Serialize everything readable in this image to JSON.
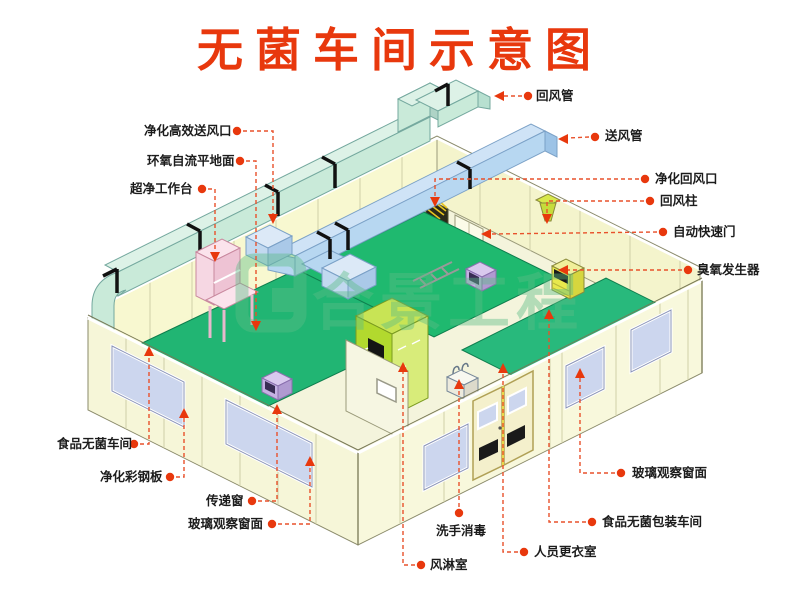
{
  "title": "无菌车间示意图",
  "watermark": {
    "text": "合景工程"
  },
  "colors": {
    "accent_red": "#e8380d",
    "leader_orange": "#f0512b",
    "wall": "#f7f7d8",
    "floor_green": "#21b573",
    "return_duct_cyan": "#c9ead9",
    "supply_duct_blue": "#b7d7f1",
    "air_shower_lime": "#b2d92e",
    "window_lavender": "#ccd6ee",
    "watermark_green": "#5bbd86"
  },
  "labels": {
    "hepa_outlet": "净化高效送风口",
    "epoxy_floor": "环氧自流平地面",
    "clean_bench": "超净工作台",
    "food_workshop": "食品无菌车间",
    "steel_panel": "净化彩钢板",
    "pass_window": "传递窗",
    "glass_window_left": "玻璃观察窗面",
    "return_duct": "回风管",
    "supply_duct": "送风管",
    "return_outlet": "净化回风口",
    "return_column": "回风柱",
    "auto_door": "自动快速门",
    "ozone_generator": "臭氧发生器",
    "glass_window_right": "玻璃观察窗面",
    "packing_workshop": "食品无菌包装车间",
    "changing_room": "人员更衣室",
    "hand_wash": "洗手消毒",
    "air_shower": "风淋室"
  }
}
